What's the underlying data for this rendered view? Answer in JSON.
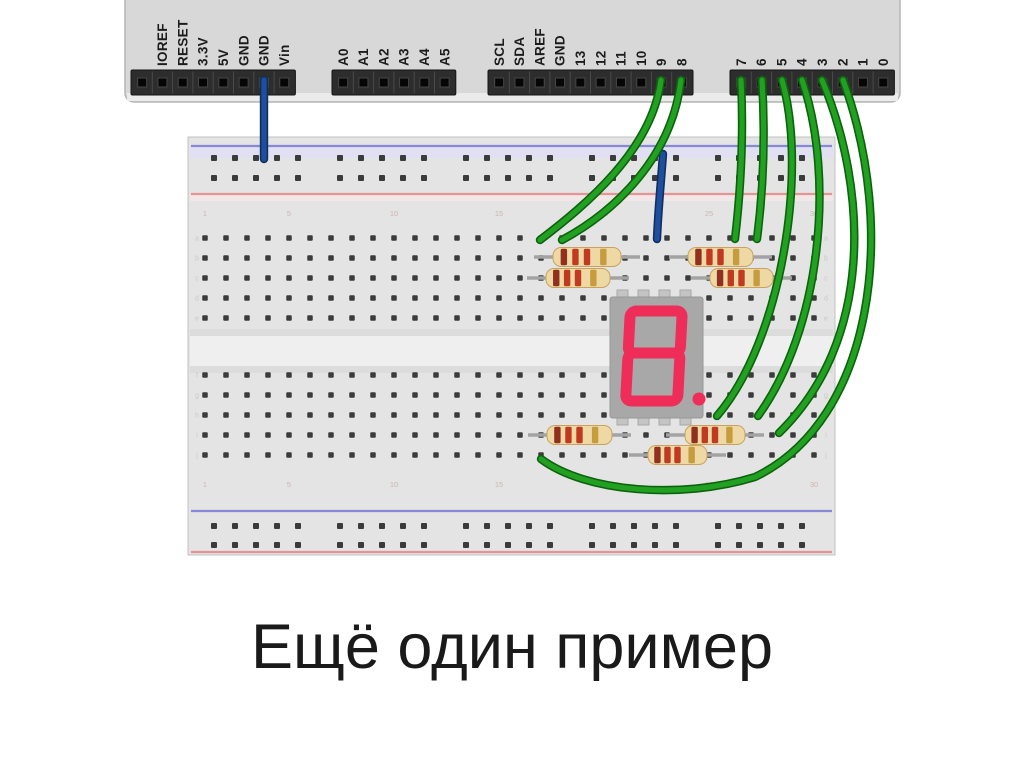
{
  "slide": {
    "title": "Ещё один пример",
    "title_color": "#1a1a1a",
    "background": "#ffffff"
  },
  "arduino": {
    "board_color": "#d8d8d8",
    "edge_color": "#b5b5b5",
    "header_color": "#2d2d2d",
    "label_color": "#1c1c1c",
    "pin_pitch": 20.3,
    "headers": [
      {
        "name": "power",
        "x": 131,
        "pin_labels": [
          "",
          "IOREF",
          "RESET",
          "3.3V",
          "5V",
          "GND",
          "GND",
          "Vin"
        ]
      },
      {
        "name": "analog-in",
        "x": 332,
        "pin_labels": [
          "A0",
          "A1",
          "A2",
          "A3",
          "A4",
          "A5"
        ]
      },
      {
        "name": "digital-13-8",
        "x": 488,
        "pin_labels": [
          "SCL",
          "SDA",
          "AREF",
          "GND",
          "13",
          "12",
          "11",
          "10",
          "9",
          "8"
        ]
      },
      {
        "name": "digital-7-0",
        "x": 730,
        "pin_labels": [
          "7",
          "6",
          "5",
          "4",
          "3",
          "2",
          "1",
          "0"
        ]
      }
    ]
  },
  "breadboard": {
    "x": 188,
    "y": 137,
    "width": 647,
    "height": 418,
    "body_color": "#e4e4e4",
    "hole_color": "#3b3b3b",
    "rail_blue": "#8888d8",
    "rail_red": "#e49494",
    "lines": {
      "blue": [
        146,
        511
      ],
      "red": [
        194,
        552
      ]
    },
    "rail_rows": [
      158,
      178,
      526,
      545
    ],
    "rail_start": 214,
    "rail_group_pitch": 126,
    "rail_hole_pitch": 21,
    "columns": 30,
    "col_start": 205,
    "col_pitch": 21,
    "rows_top": [
      238,
      258,
      278,
      298,
      318
    ],
    "rows_bottom": [
      375,
      395,
      415,
      435,
      455
    ],
    "channel": {
      "y1": 329,
      "y2": 373
    },
    "column_marks": [
      {
        "label": "1",
        "col": 0
      },
      {
        "label": "5",
        "col": 4
      },
      {
        "label": "10",
        "col": 9
      },
      {
        "label": "15",
        "col": 14
      },
      {
        "label": "20",
        "col": 19
      },
      {
        "label": "25",
        "col": 24
      },
      {
        "label": "30",
        "col": 29
      }
    ],
    "row_marks_top": [
      "a",
      "b",
      "c",
      "d",
      "e"
    ],
    "row_marks_bottom": [
      "f",
      "g",
      "h",
      "i",
      "j"
    ]
  },
  "seven_segment": {
    "digit": "8",
    "decimal_point": true,
    "x": 610,
    "y": 297,
    "width": 93,
    "height": 121,
    "body_color": "#a8a8a8",
    "tab_color": "#c4c4c4",
    "tabs_x": [
      617,
      638,
      659,
      680
    ],
    "segment_color": "#ee2d59"
  },
  "resistors": {
    "body_color": "#eed9a4",
    "body_edge": "#c8a35f",
    "lead_color": "#a3a3a3",
    "band_colors": [
      "#92301f",
      "#c03a22",
      "#c03a22",
      "#c79c3f"
    ],
    "items": [
      {
        "x1": 553,
        "x2": 621,
        "y": 257
      },
      {
        "x1": 546,
        "x2": 610,
        "y": 278
      },
      {
        "x1": 688,
        "x2": 753,
        "y": 257
      },
      {
        "x1": 710,
        "x2": 773,
        "y": 278
      },
      {
        "x1": 547,
        "x2": 612,
        "y": 435
      },
      {
        "x1": 648,
        "x2": 707,
        "y": 455
      },
      {
        "x1": 685,
        "x2": 745,
        "y": 435
      }
    ]
  },
  "wires": {
    "green": {
      "outline": "#0d620d",
      "core": "#22a022"
    },
    "blue": {
      "outline": "#122e5e",
      "core": "#1e4f9e"
    },
    "items": [
      {
        "name": "gnd-to-top-rail",
        "color": "blue",
        "path": "M264,80 L264,159"
      },
      {
        "name": "top-rail-to-display-common",
        "color": "blue",
        "path": "M663,154 C661,182 658,212 657,239"
      },
      {
        "name": "pin9-to-breadboard",
        "color": "green",
        "path": "M661,80 C652,150 586,205 540,240"
      },
      {
        "name": "pin8-to-breadboard",
        "color": "green",
        "path": "M681,80 C672,158 614,212 562,240"
      },
      {
        "name": "pin7-to-breadboard",
        "color": "green",
        "path": "M741,80 C744,140 740,196 735,239"
      },
      {
        "name": "pin6-to-breadboard",
        "color": "green",
        "path": "M762,80 C766,145 762,200 757,239"
      },
      {
        "name": "pin5-to-breadboard",
        "color": "green",
        "path": "M782,80 C808,170 782,340 717,416"
      },
      {
        "name": "pin4-to-breadboard",
        "color": "green",
        "path": "M802,80 C836,180 820,330 758,416"
      },
      {
        "name": "pin3-to-breadboard",
        "color": "green",
        "path": "M822,80 C868,190 874,340 779,433"
      },
      {
        "name": "pin2-to-breadboard",
        "color": "green",
        "path": "M843,80 C898,230 874,420 755,477 C680,500 585,492 541,459"
      }
    ]
  }
}
